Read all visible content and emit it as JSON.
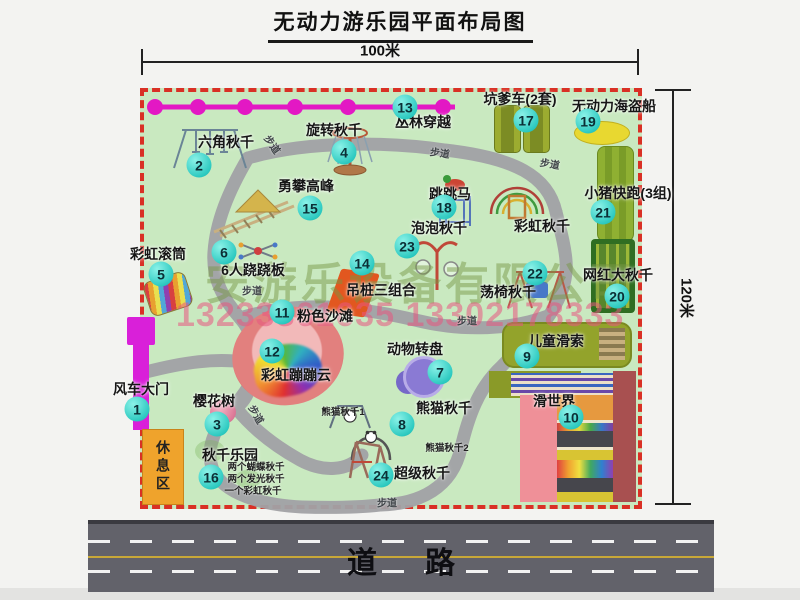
{
  "title": "无动力游乐园平面布局图",
  "dimension_top": "100米",
  "dimension_right": "120米",
  "road_label": "道路",
  "rest_area_label": "休息区",
  "watermark": {
    "company": "安游乐设备有限公司",
    "phones": "13233861635 13302178333"
  },
  "colors": {
    "park_green": "#c9e9c0",
    "border_red": "#d93025",
    "badge_teal": "#2cc9c0",
    "zipline_magenta": "#e318c4",
    "gate_magenta": "#d920d9",
    "rest_area_orange": "#efa32c",
    "road_gray": "#62626a"
  },
  "attractions": [
    {
      "num": "1",
      "label": "风车大门",
      "badge": {
        "x": 137,
        "y": 409
      },
      "text": {
        "x": 141,
        "y": 389
      }
    },
    {
      "num": "2",
      "label": "六角秋千",
      "badge": {
        "x": 199,
        "y": 165
      },
      "text": {
        "x": 226,
        "y": 142
      }
    },
    {
      "num": "3",
      "label": "樱花树",
      "badge": {
        "x": 217,
        "y": 424
      },
      "text": {
        "x": 214,
        "y": 401
      }
    },
    {
      "num": "4",
      "label": "旋转秋千",
      "badge": {
        "x": 344,
        "y": 152
      },
      "text": {
        "x": 334,
        "y": 130
      }
    },
    {
      "num": "5",
      "label": "彩虹滚筒",
      "badge": {
        "x": 161,
        "y": 274
      },
      "text": {
        "x": 158,
        "y": 254
      }
    },
    {
      "num": "6",
      "label": "6人跷跷板",
      "badge": {
        "x": 224,
        "y": 252
      },
      "text": {
        "x": 253,
        "y": 270
      }
    },
    {
      "num": "7",
      "label": "动物转盘",
      "badge": {
        "x": 440,
        "y": 372
      },
      "text": {
        "x": 415,
        "y": 349
      }
    },
    {
      "num": "8",
      "label": "熊猫秋千",
      "badge": {
        "x": 402,
        "y": 424
      },
      "text": {
        "x": 444,
        "y": 408
      }
    },
    {
      "num": "9",
      "label": "儿童滑索",
      "badge": {
        "x": 527,
        "y": 356
      },
      "text": {
        "x": 556,
        "y": 341
      }
    },
    {
      "num": "10",
      "label": "滑世界",
      "badge": {
        "x": 571,
        "y": 417
      },
      "text": {
        "x": 554,
        "y": 401
      }
    },
    {
      "num": "11",
      "label": "粉色沙滩",
      "badge": {
        "x": 282,
        "y": 312
      },
      "text": {
        "x": 325,
        "y": 316
      }
    },
    {
      "num": "12",
      "label": "彩虹蹦蹦云",
      "badge": {
        "x": 272,
        "y": 351
      },
      "text": {
        "x": 296,
        "y": 375
      }
    },
    {
      "num": "13",
      "label": "丛林穿越",
      "badge": {
        "x": 405,
        "y": 107
      },
      "text": {
        "x": 423,
        "y": 122
      }
    },
    {
      "num": "14",
      "label": "吊桩三组合",
      "badge": {
        "x": 362,
        "y": 263
      },
      "text": {
        "x": 381,
        "y": 290
      }
    },
    {
      "num": "15",
      "label": "勇攀高峰",
      "badge": {
        "x": 310,
        "y": 208
      },
      "text": {
        "x": 306,
        "y": 186
      }
    },
    {
      "num": "16",
      "label": "秋千乐园",
      "badge": {
        "x": 211,
        "y": 477
      },
      "text": {
        "x": 230,
        "y": 455
      }
    },
    {
      "num": "17",
      "label": "坑爹车(2套)",
      "badge": {
        "x": 526,
        "y": 120
      },
      "text": {
        "x": 520,
        "y": 99
      }
    },
    {
      "num": "18",
      "label": "跳跳马",
      "badge": {
        "x": 444,
        "y": 207
      },
      "text": {
        "x": 450,
        "y": 194
      }
    },
    {
      "num": "19",
      "label": "无动力海盗船",
      "badge": {
        "x": 588,
        "y": 121
      },
      "text": {
        "x": 614,
        "y": 106
      }
    },
    {
      "num": "20",
      "label": "网红大秋千",
      "badge": {
        "x": 617,
        "y": 296
      },
      "text": {
        "x": 618,
        "y": 275
      }
    },
    {
      "num": "21",
      "label": "小猪快跑(3组)",
      "badge": {
        "x": 603,
        "y": 212
      },
      "text": {
        "x": 628,
        "y": 193
      }
    },
    {
      "num": "22",
      "label": "荡椅秋千",
      "badge": {
        "x": 535,
        "y": 273
      },
      "text": {
        "x": 508,
        "y": 292
      }
    },
    {
      "num": "23",
      "label": "泡泡秋千",
      "badge": {
        "x": 407,
        "y": 246
      },
      "text": {
        "x": 439,
        "y": 228
      }
    },
    {
      "num": "24",
      "label": "超级秋千",
      "badge": {
        "x": 381,
        "y": 475
      },
      "text": {
        "x": 422,
        "y": 473
      }
    },
    {
      "num": "",
      "label": "彩虹秋千",
      "text": {
        "x": 542,
        "y": 226
      }
    }
  ],
  "sub_labels": [
    {
      "text": "熊猫秋千1",
      "x": 343,
      "y": 411
    },
    {
      "text": "熊猫秋千2",
      "x": 447,
      "y": 447
    },
    {
      "text": "两个蝴蝶秋千",
      "x": 256,
      "y": 466
    },
    {
      "text": "两个发光秋千",
      "x": 256,
      "y": 478
    },
    {
      "text": "一个彩虹秋千",
      "x": 253,
      "y": 490
    }
  ],
  "path_labels": [
    {
      "text": "步道",
      "x": 273,
      "y": 144,
      "rot": 55
    },
    {
      "text": "步道",
      "x": 440,
      "y": 152,
      "rot": 8
    },
    {
      "text": "步道",
      "x": 550,
      "y": 163,
      "rot": 10
    },
    {
      "text": "步道",
      "x": 252,
      "y": 290,
      "rot": 0
    },
    {
      "text": "步道",
      "x": 467,
      "y": 320,
      "rot": 0
    },
    {
      "text": "步道",
      "x": 257,
      "y": 414,
      "rot": 60
    },
    {
      "text": "步道",
      "x": 387,
      "y": 502,
      "rot": 0
    }
  ]
}
